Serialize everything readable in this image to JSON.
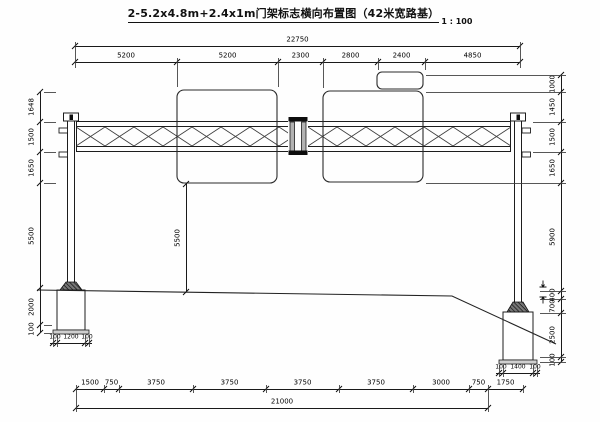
{
  "title": {
    "text": "2-5.2x4.8m+2.4x1m门架标志横向布置图（42米宽路基）",
    "scale": "1 : 100"
  },
  "drawing": {
    "type": "gantry-sign-elevation",
    "panels": [
      "5.2x4.8m sign panel (left)",
      "5.2x4.8m sign panel (right)",
      "2.4x1m sign panel (small)"
    ],
    "roadbed_width_label": "42米宽路基"
  },
  "dims": {
    "chains": [
      {
        "name": "top-total",
        "dir": "h",
        "line": 46,
        "from": 75,
        "to": 520,
        "ticks": [
          75,
          520
        ],
        "labels": [
          "22750"
        ],
        "label_off": -6,
        "fs": 7
      },
      {
        "name": "top-segments",
        "dir": "h",
        "line": 62,
        "from": 75,
        "to": 520,
        "ticks": [
          75,
          177,
          278,
          323,
          378,
          425,
          520
        ],
        "labels": [
          "5200",
          "5200",
          "2300",
          "2800",
          "2400",
          "4850"
        ],
        "label_off": -6,
        "fs": 7
      },
      {
        "name": "left-height-chain",
        "dir": "v",
        "line": 40,
        "from": 92,
        "to": 333,
        "ticks": [
          92,
          122,
          152,
          183,
          288,
          325,
          333
        ],
        "labels": [
          "1648",
          "1500",
          "1650",
          "5500",
          "2000",
          "100"
        ],
        "label_off": -8,
        "fs": 7
      },
      {
        "name": "right-height-chain",
        "dir": "v",
        "line": 561,
        "from": 75,
        "to": 362,
        "ticks": [
          75,
          92,
          122,
          152,
          183,
          291,
          299,
          313,
          357,
          362
        ],
        "labels": [
          "1000",
          "1450",
          "1500",
          "1650",
          "5900",
          "400",
          "700",
          "2500",
          "100"
        ],
        "label_off": -8,
        "fs": 7
      },
      {
        "name": "clearance-height",
        "dir": "v",
        "line": 186,
        "from": 184,
        "to": 292,
        "ticks": [
          184,
          292
        ],
        "labels": [
          "5500"
        ],
        "label_off": -8,
        "fs": 7
      },
      {
        "name": "bottom-segments",
        "dir": "h",
        "line": 389,
        "from": 76,
        "to": 523,
        "ticks": [
          76,
          104,
          119,
          193,
          266,
          339,
          413,
          469,
          488,
          523
        ],
        "labels": [
          "1500",
          "750",
          "3750",
          "3750",
          "3750",
          "3750",
          "3000",
          "750",
          "1750"
        ],
        "label_off": -6,
        "fs": 7
      },
      {
        "name": "bottom-total",
        "dir": "h",
        "line": 408,
        "from": 76,
        "to": 488,
        "ticks": [
          76,
          488
        ],
        "labels": [
          "21000"
        ],
        "label_off": -6,
        "fs": 7
      },
      {
        "name": "left-footing-width",
        "dir": "h",
        "line": 343,
        "from": 50,
        "to": 92,
        "ticks": [
          53,
          57,
          85,
          89
        ],
        "labels": [
          "100",
          "1200",
          "100"
        ],
        "label_off": -6,
        "fs": 6
      },
      {
        "name": "right-footing-width",
        "dir": "h",
        "line": 373,
        "from": 496,
        "to": 540,
        "ticks": [
          499,
          503,
          533,
          537
        ],
        "labels": [
          "100",
          "1400",
          "100"
        ],
        "label_off": -6,
        "fs": 6
      }
    ]
  }
}
